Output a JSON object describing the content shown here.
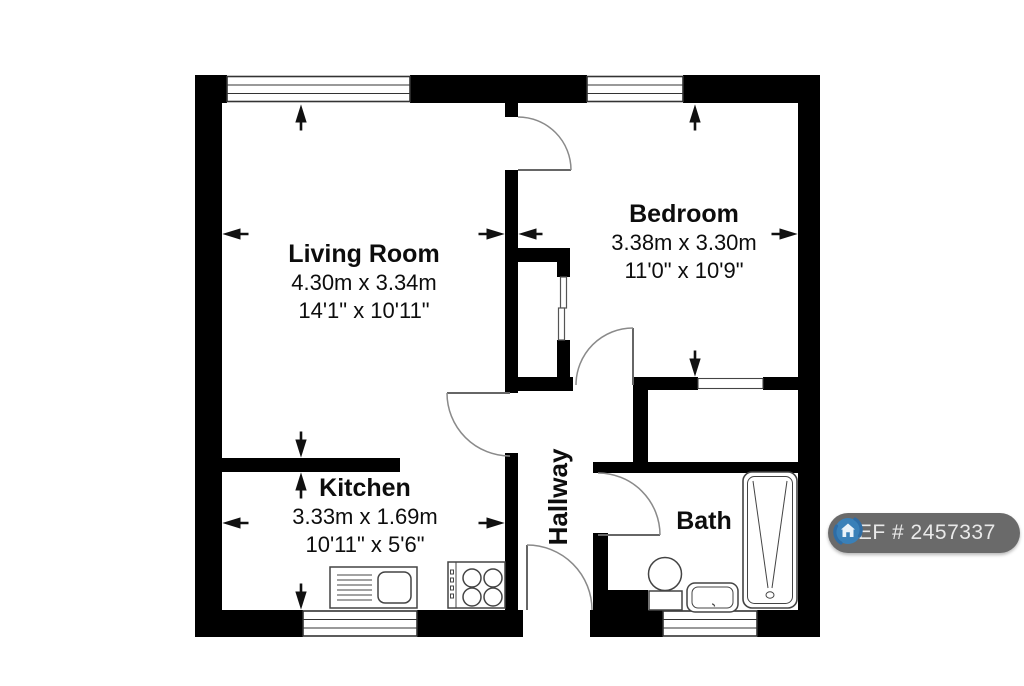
{
  "rooms": {
    "living_room": {
      "name": "Living Room",
      "metric": "4.30m x 3.34m",
      "imperial": "14'1\" x 10'11\""
    },
    "bedroom": {
      "name": "Bedroom",
      "metric": "3.38m x 3.30m",
      "imperial": "11'0\" x 10'9\""
    },
    "kitchen": {
      "name": "Kitchen",
      "metric": "3.33m x 1.69m",
      "imperial": "10'11\" x 5'6\""
    },
    "hallway": {
      "name": "Hallway"
    },
    "bath": {
      "name": "Bath"
    }
  },
  "badge": {
    "ref_label": "REF # 2457337",
    "background": "#6a6a6a",
    "text_color": "#e9e9e9",
    "icon": "house-logo-icon",
    "icon_ring_color": "#2e6da6",
    "icon_fill_color": "#3a80b8"
  },
  "colors": {
    "wall": "#000000",
    "fixture_line": "#444444",
    "door_arc": "#8a8a8a",
    "background": "#ffffff"
  }
}
